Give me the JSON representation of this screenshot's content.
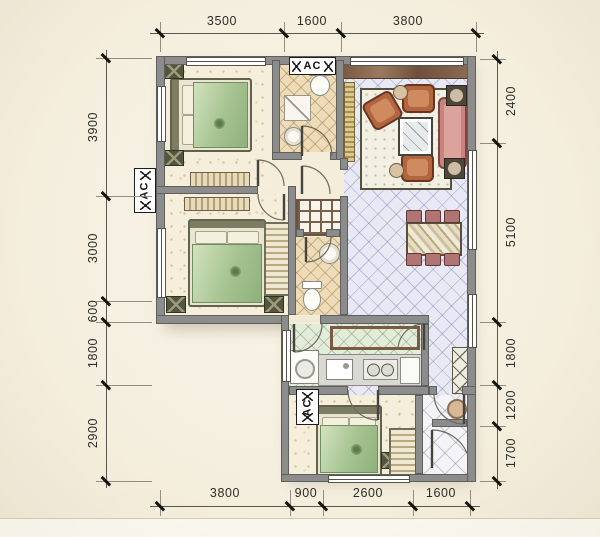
{
  "dimensions": {
    "top": [
      "3500",
      "1600",
      "3800"
    ],
    "bottom": [
      "3800",
      "900",
      "2600",
      "1600"
    ],
    "left": [
      "3900",
      "3000",
      "600",
      "1800",
      "2900"
    ],
    "right": [
      "2400",
      "5100",
      "1800",
      "1200",
      "1700"
    ]
  },
  "ac": {
    "top": "AC",
    "left": "AC",
    "bottom": "AC"
  },
  "colors": {
    "background": "#f6f1e4",
    "wall": "#8c8c8c",
    "living_tile": "#e9e9f6",
    "bath_tile": "#eddcb7",
    "kitchen_tile": "#e3ecd9",
    "balcony_tile": "#f4f4f8",
    "bedroom_floor": "#f4eeda",
    "bed_green": "#a9c497",
    "sofa_mauve": "#c8837e",
    "armchair_brown": "#b2663f",
    "wood_brown": "#7a5a45"
  }
}
